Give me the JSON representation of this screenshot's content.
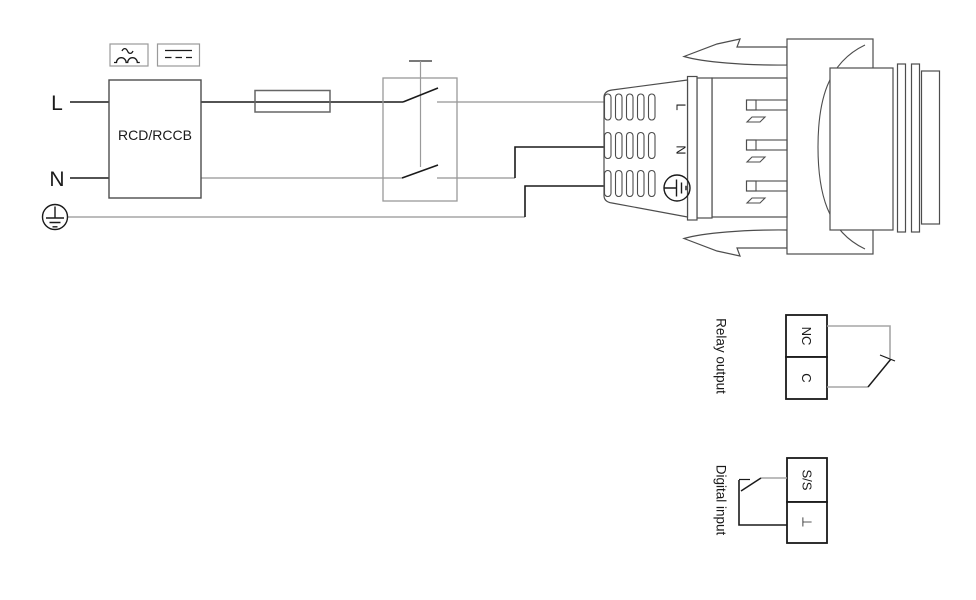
{
  "power_supply": {
    "line_label": "L",
    "neutral_label": "N",
    "rcd_label": "RCD/RCCB"
  },
  "plug": {
    "line_label": "L",
    "neutral_label": "N"
  },
  "relay_output": {
    "label": "Relay output",
    "terminals": [
      {
        "label": "NC"
      },
      {
        "label": "C"
      }
    ]
  },
  "digital_input": {
    "label": "Digital input",
    "terminals": [
      {
        "label": "S/S"
      },
      {
        "label": "⊥"
      }
    ]
  },
  "icons": {
    "earth_icon": "protective-earth symbol (circle with ground)",
    "plug_earth_icon": "protective-earth symbol on plug",
    "pulsating_dc_icon": "RCD sensitivity: pulsating DC (tilde over half-waves)",
    "smooth_dc_icon": "RCD sensitivity: smooth DC (solid line over dashed line)",
    "fuse_icon": "fuse (rectangle with line through)",
    "switch_icon": "double-pole mains switch",
    "nc_contact_icon": "normally-closed relay contact",
    "input_switch_icon": "external switch for digital input"
  },
  "colors": {
    "background": "#ffffff",
    "wire_dark": "#1a1a1a",
    "wire_gray": "#a6a6a6",
    "outline": "#4d4d4d"
  }
}
